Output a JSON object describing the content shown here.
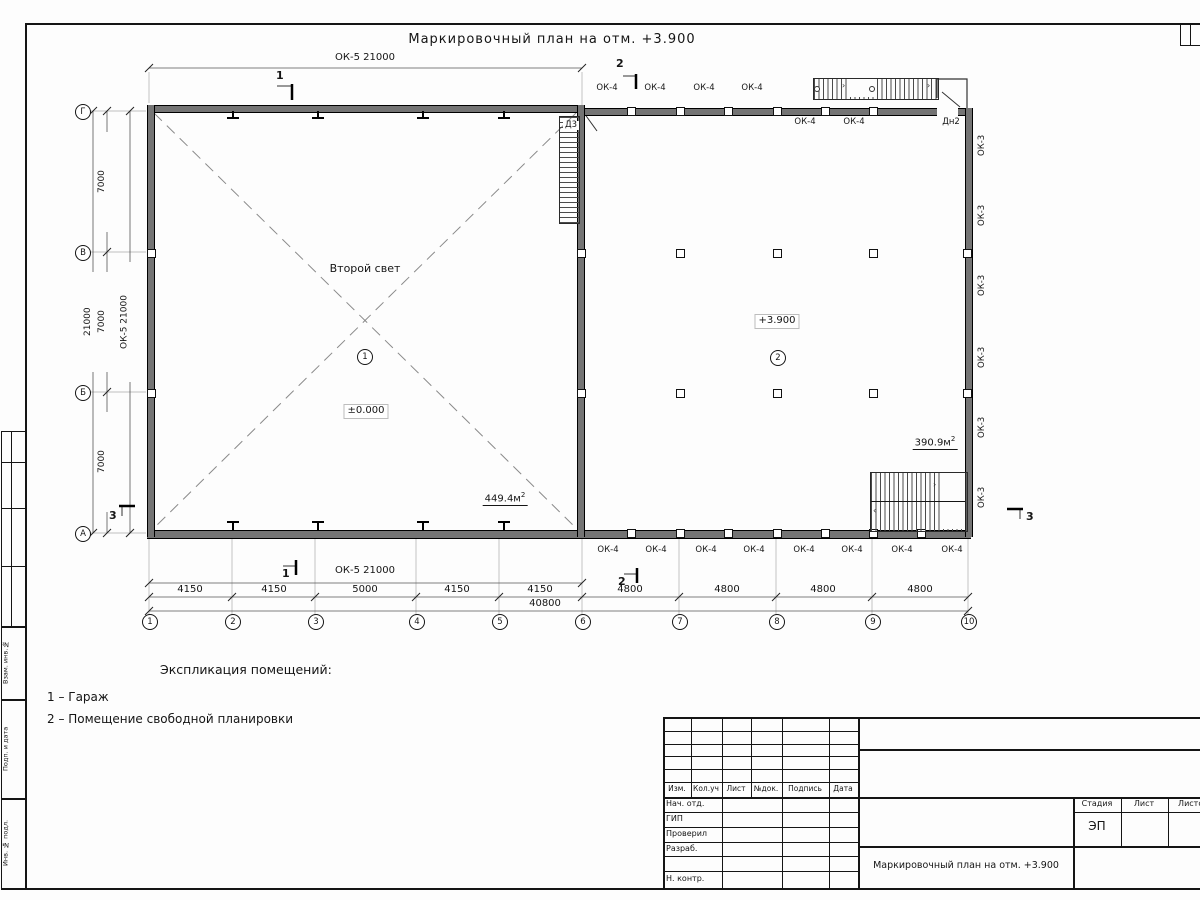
{
  "sheet": {
    "title": "Маркировочный план на отм. +3.900"
  },
  "plan": {
    "room1": {
      "note": "Второй свет",
      "number": "1",
      "level": "±0.000",
      "area": "449.4м",
      "area_sup": "2"
    },
    "room2": {
      "number": "2",
      "level": "+3.900",
      "area": "390.9м",
      "area_sup": "2"
    },
    "doors": {
      "d3": "Д3",
      "dn2": "Дн2"
    },
    "ok4_top": [
      "ОК-4",
      "ОК-4",
      "ОК-4",
      "ОК-4"
    ],
    "ok4_top_below": [
      "ОК-4",
      "ОК-4"
    ],
    "ok4_bottom": [
      "ОК-4",
      "ОК-4",
      "ОК-4",
      "ОК-4",
      "ОК-4",
      "ОК-4",
      "ОК-4",
      "ОК-4"
    ],
    "ok3_right": [
      "ОК-3",
      "ОК-3",
      "ОК-3",
      "ОК-3",
      "ОК-3",
      "ОК-3"
    ]
  },
  "dims": {
    "top_ok5": "ОК-5 21000",
    "bottom_ok5": "ОК-5 21000",
    "left_ok5": "ОК-5 21000",
    "left_total": "21000",
    "left_7000": [
      "7000",
      "7000",
      "7000"
    ],
    "bays": [
      "4150",
      "4150",
      "5000",
      "4150",
      "4150",
      "4800",
      "4800",
      "4800",
      "4800"
    ],
    "total": "40800"
  },
  "axes": {
    "cols": [
      "1",
      "2",
      "3",
      "4",
      "5",
      "6",
      "7",
      "8",
      "9",
      "10"
    ],
    "rows": [
      "Г",
      "В",
      "Б",
      "А"
    ]
  },
  "sections": {
    "s1": "1",
    "s2": "2",
    "s3": "3"
  },
  "legend": {
    "heading": "Экспликация помещений:",
    "items": [
      "1 – Гараж",
      "2 – Помещение свободной планировки"
    ]
  },
  "titleblock": {
    "change_cols": [
      "Изм.",
      "Кол.уч",
      "Лист",
      "№док.",
      "Подпись",
      "Дата"
    ],
    "roles": [
      "Нач. отд.",
      "ГИП",
      "Проверил",
      "Разраб.",
      "Н. контр."
    ],
    "stage_cols": [
      "Стадия",
      "Лист",
      "Листов"
    ],
    "stage_value": "ЭП",
    "doc_title": "Маркировочный план на отм. +3.900"
  },
  "frame": {
    "side_labels": [
      "Взам. инв.№",
      "Подп. и дата",
      "Инв. № подл."
    ]
  }
}
